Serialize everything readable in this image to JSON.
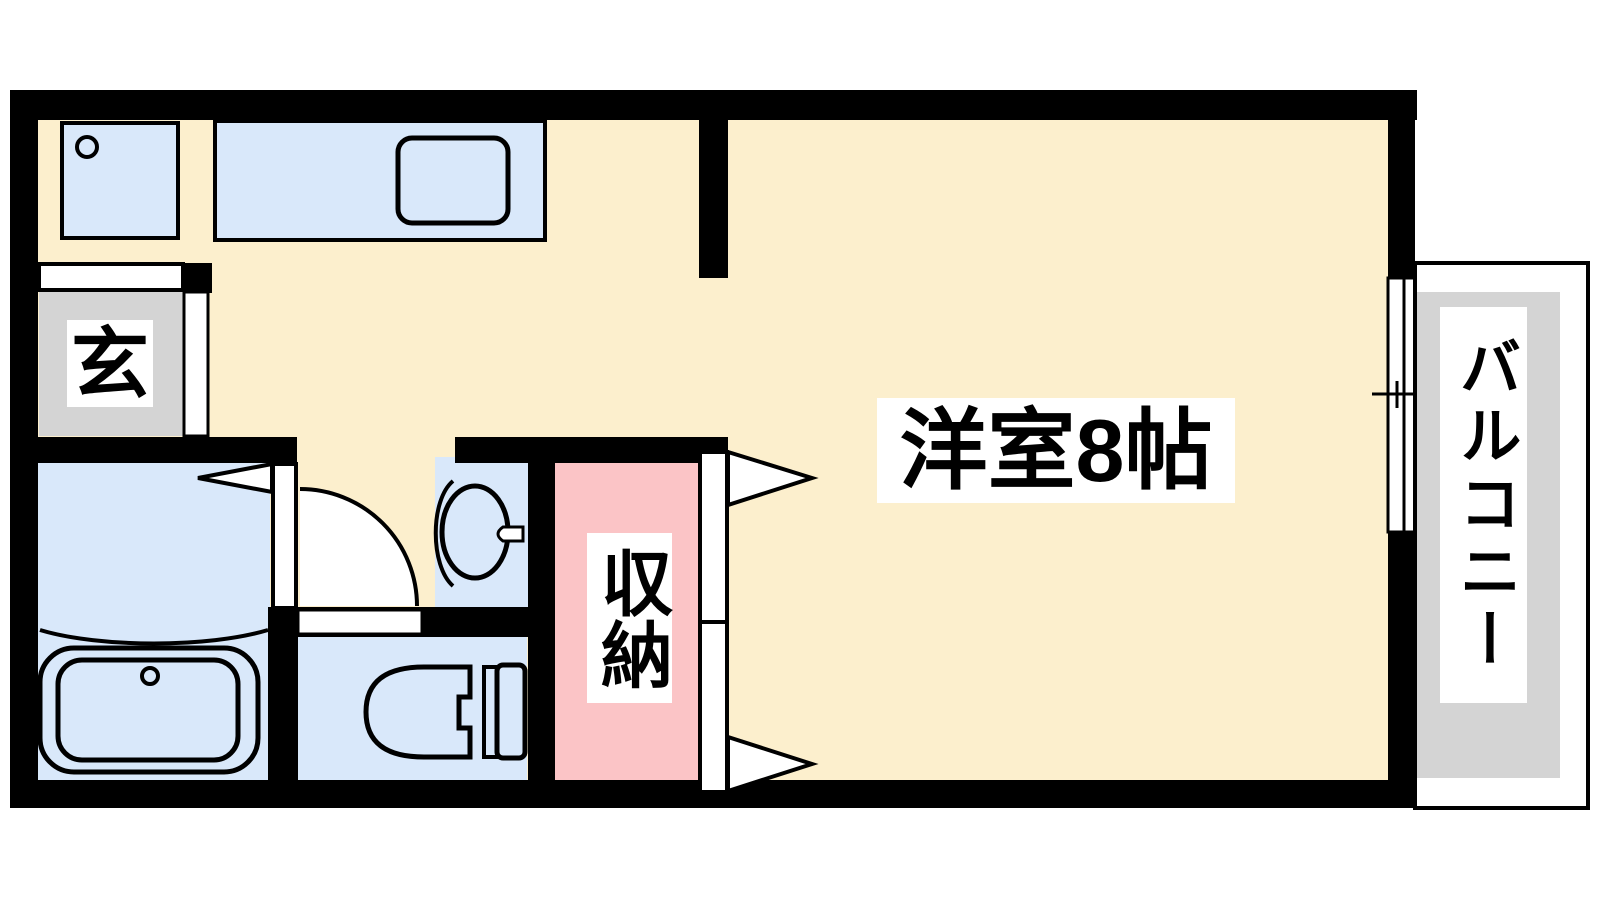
{
  "floor_plan": {
    "kind": "apartment-floor-plan",
    "rooms": [
      {
        "id": "western_room",
        "label": "洋室8帖"
      },
      {
        "id": "entrance",
        "label": "玄"
      },
      {
        "id": "storage",
        "label": "収納"
      },
      {
        "id": "balcony",
        "label": "バルコニー"
      }
    ],
    "fixtures": [
      "kitchen-counter",
      "kitchen-sink",
      "washing-machine-pan",
      "bathtub",
      "washbasin",
      "toilet",
      "entrance-step",
      "hinged-door",
      "sliding-window",
      "closet-doors"
    ],
    "colors": {
      "wall": "#000000",
      "floor_cream": "#FCEFCD",
      "fixture_blue": "#D9E8FA",
      "storage_pink": "#FBC4C6",
      "surface_gray": "#D4D4D4",
      "background": "#FFFFFF",
      "label_bg": "#FFFFFF",
      "label_text": "#000000"
    }
  }
}
